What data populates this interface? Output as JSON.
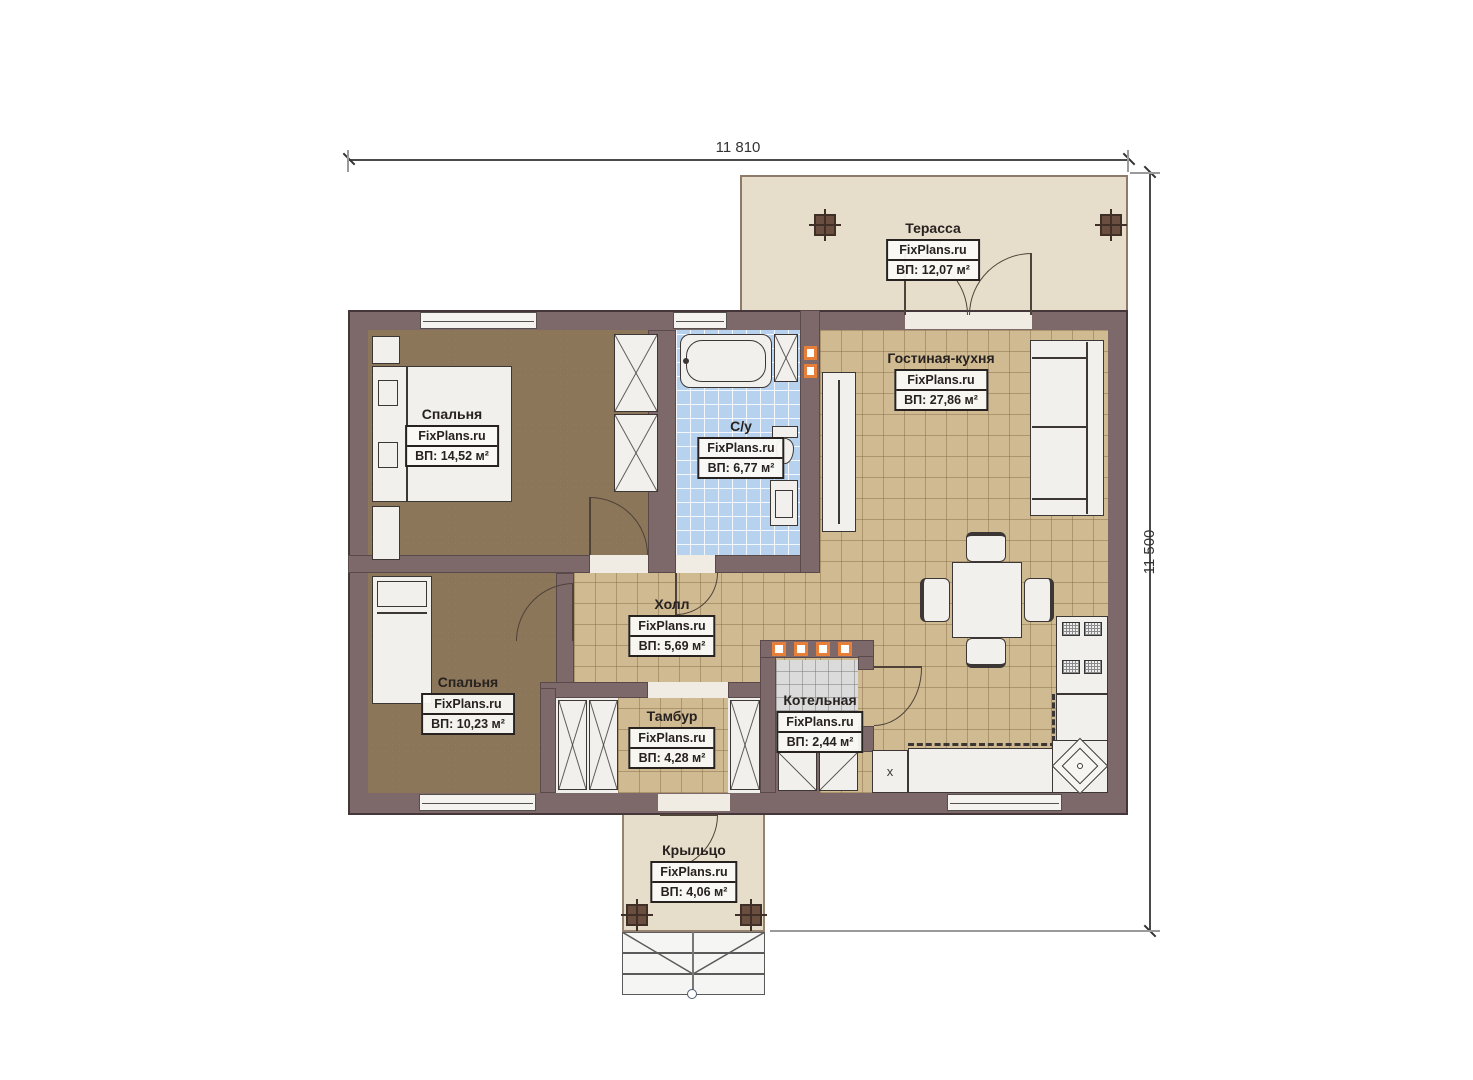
{
  "plan": {
    "dimensions": {
      "width_label": "11 810",
      "height_label": "11 500"
    },
    "rooms": [
      {
        "id": "terrace",
        "name": "Терасса",
        "brand": "FixPlans.ru",
        "area": "ВП: 12,07 м²"
      },
      {
        "id": "living-kitchen",
        "name": "Гостиная-кухня",
        "brand": "FixPlans.ru",
        "area": "ВП: 27,86 м²"
      },
      {
        "id": "bedroom-1",
        "name": "Спальня",
        "brand": "FixPlans.ru",
        "area": "ВП: 14,52 м²"
      },
      {
        "id": "bathroom",
        "name": "С/у",
        "brand": "FixPlans.ru",
        "area": "ВП: 6,77 м²"
      },
      {
        "id": "hall",
        "name": "Холл",
        "brand": "FixPlans.ru",
        "area": "ВП: 5,69 м²"
      },
      {
        "id": "bedroom-2",
        "name": "Спальня",
        "brand": "FixPlans.ru",
        "area": "ВП: 10,23 м²"
      },
      {
        "id": "vestibule",
        "name": "Тамбур",
        "brand": "FixPlans.ru",
        "area": "ВП: 4,28 м²"
      },
      {
        "id": "boiler-room",
        "name": "Котельная",
        "brand": "FixPlans.ru",
        "area": "ВП: 2,44 м²"
      },
      {
        "id": "porch",
        "name": "Крыльцо",
        "brand": "FixPlans.ru",
        "area": "ВП: 4,06 м²"
      }
    ],
    "markers": {
      "kitchen_x": "x"
    },
    "colors": {
      "wall": "#7d686a",
      "floor_bedroom": "#8c765a",
      "floor_tile_tan": "#cfba92",
      "floor_tile_blue": "#b7d2ee",
      "floor_tile_gray": "#dbdbdb",
      "terrace_fill": "#e7ddcb",
      "accent_orange": "#e57f3a"
    }
  }
}
